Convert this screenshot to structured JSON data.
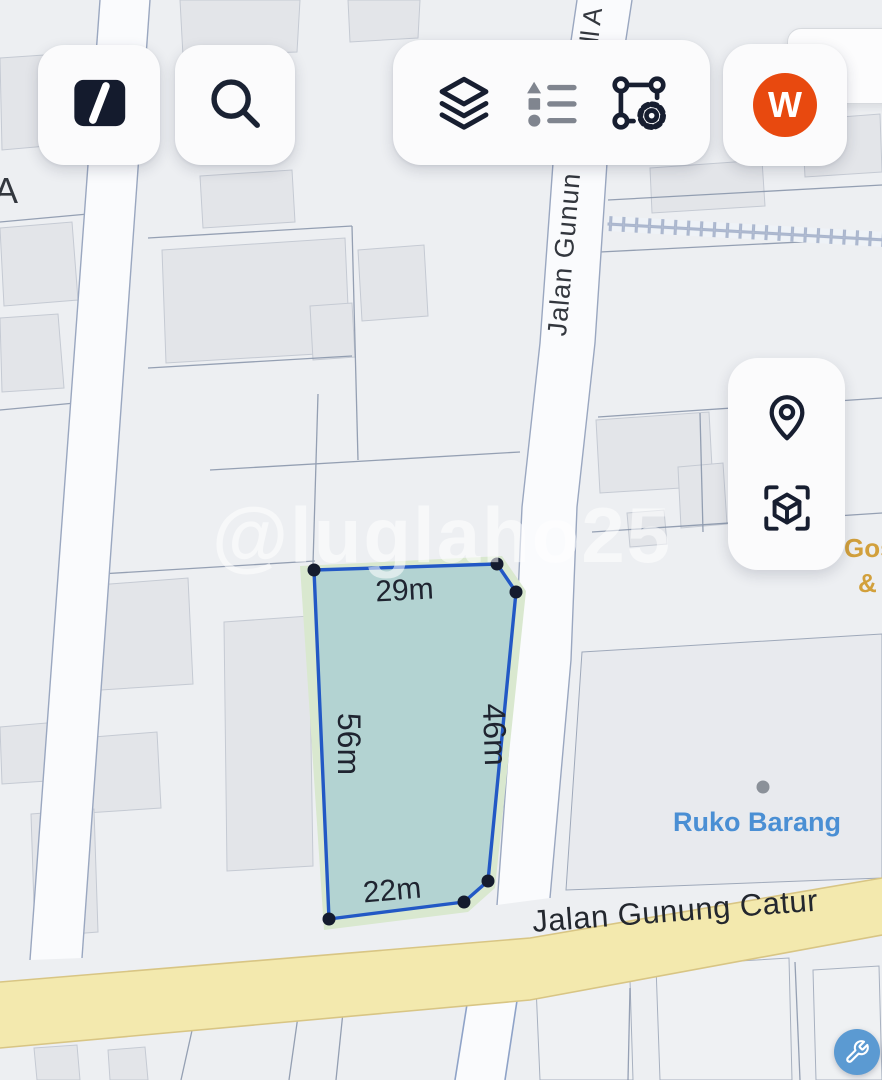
{
  "toolbar": {
    "logo_icon": "brand-slash-icon",
    "search_icon": "magnifier-icon",
    "layers_icon": "layers-icon",
    "legend_icon": "legend-list-icon",
    "polygon_settings_icon": "polygon-gear-icon",
    "avatar_initial": "W"
  },
  "side_panel": {
    "locate_icon": "location-pin-icon",
    "view3d_icon": "cube-3d-icon"
  },
  "bottom": {
    "wrench_icon": "wrench-icon"
  },
  "map": {
    "watermark": "@luglaho25",
    "streets": {
      "vertical_label": "Jalan Gunun",
      "vertical_fragment_top": "ll A",
      "left_fragment": "A",
      "main_road_label": "Jalan Gunung Catur"
    },
    "poi": {
      "ruko_label": "Ruko Barang",
      "gos_line1": "Gos",
      "gos_line2": "&"
    },
    "plot_measurements": {
      "top": "29m",
      "left": "56m",
      "right": "46m",
      "bottom": "22m"
    },
    "colors": {
      "plot_stroke": "#2258c5",
      "plot_fill": "rgba(164,203,211,0.72)",
      "plot_vertex": "#141b2e",
      "plot_underlay_green": "#d9e8cf",
      "road_fill": "#f3e9ae",
      "road_edge": "#d8c584",
      "poi_ruko_blue": "#4a8fd4",
      "poi_gos_amber": "#d2a03c",
      "avatar_bg": "#e8490f",
      "wrench_btn_bg": "#5b9ad2",
      "map_base": "#edeff2",
      "building_fill": "#e3e5e9"
    }
  }
}
